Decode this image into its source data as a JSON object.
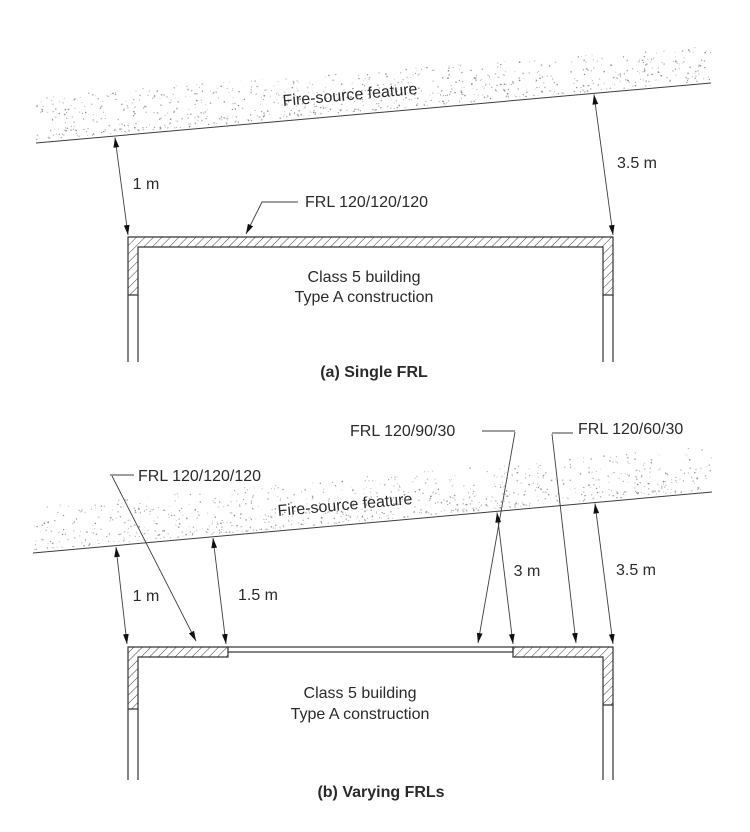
{
  "diagram_a": {
    "caption": "(a) Single FRL",
    "fire_source": "Fire-source feature",
    "frl_label": "FRL 120/120/120",
    "dim_left": "1 m",
    "dim_right": "3.5 m",
    "building_line1": "Class 5 building",
    "building_line2": "Type A construction"
  },
  "diagram_b": {
    "caption": "(b) Varying FRLs",
    "fire_source": "Fire-source feature",
    "frl_labels": [
      "FRL 120/120/120",
      "FRL 120/90/30",
      "FRL 120/60/30"
    ],
    "dims": [
      "1 m",
      "1.5 m",
      "3 m",
      "3.5 m"
    ],
    "building_line1": "Class 5 building",
    "building_line2": "Type A construction"
  },
  "colors": {
    "line": "#3d3d3d",
    "wall_outline": "#333333",
    "text": "#2a2a2a",
    "arrowhead": "#111111",
    "stipple_dot": "#8b8b8b",
    "background": "#ffffff"
  }
}
